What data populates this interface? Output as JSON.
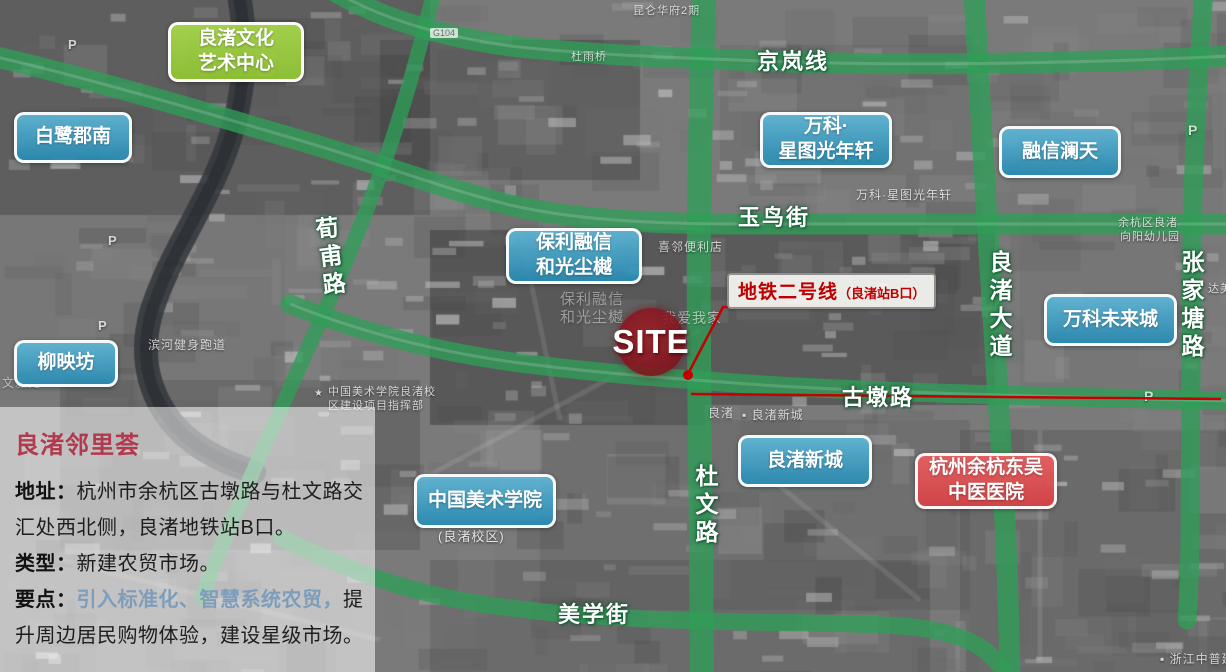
{
  "colors": {
    "road_green": "#2f9e57",
    "annotation_red": "#c40000",
    "site_fill_red": "#8c1622",
    "label_blue": "#2e94c0",
    "label_green": "#99c93c",
    "label_red": "#dd4f52",
    "panel_title_red": "#b13a4e",
    "panel_highlight_blue": "#7e9dbb"
  },
  "map": {
    "site_marker": {
      "label": "SITE"
    },
    "metro_callout": {
      "name": "地铁二号线",
      "station": "（良渚站B口）"
    },
    "place_labels": [
      {
        "id": "liangzhu-culture-art-center",
        "style": "green",
        "lines": [
          "良渚文化",
          "艺术中心"
        ],
        "x": 168,
        "y": 22,
        "w": 136,
        "h": 60
      },
      {
        "id": "bailu-jun-south",
        "style": "blue",
        "lines": [
          "白鹭郡南"
        ],
        "x": 14,
        "y": 112,
        "w": 118,
        "h": 51
      },
      {
        "id": "liuyingfang",
        "style": "blue",
        "lines": [
          "柳映坊"
        ],
        "x": 14,
        "y": 340,
        "w": 104,
        "h": 47
      },
      {
        "id": "baoli-rongxin-heguang-chenyue",
        "style": "blue",
        "lines": [
          "保利融信",
          "和光尘樾"
        ],
        "x": 506,
        "y": 228,
        "w": 136,
        "h": 56
      },
      {
        "id": "vanke-xingtu-guangnianxuan",
        "style": "blue",
        "lines": [
          "万科·",
          "星图光年轩"
        ],
        "x": 760,
        "y": 112,
        "w": 132,
        "h": 56
      },
      {
        "id": "rongxin-lantian",
        "style": "blue",
        "lines": [
          "融信澜天"
        ],
        "x": 999,
        "y": 126,
        "w": 122,
        "h": 52
      },
      {
        "id": "vanke-future-city",
        "style": "blue",
        "lines": [
          "万科未来城"
        ],
        "x": 1044,
        "y": 294,
        "w": 133,
        "h": 52
      },
      {
        "id": "liangzhu-new-town",
        "style": "blue",
        "lines": [
          "良渚新城"
        ],
        "x": 738,
        "y": 435,
        "w": 134,
        "h": 52
      },
      {
        "id": "china-academy-of-art",
        "style": "blue",
        "lines": [
          "中国美术学院"
        ],
        "x": 414,
        "y": 474,
        "w": 142,
        "h": 54
      },
      {
        "id": "hangzhou-yuhang-dongwu-hospital",
        "style": "red",
        "lines": [
          "杭州余杭东吴",
          "中医医院"
        ],
        "x": 915,
        "y": 453,
        "w": 142,
        "h": 56
      }
    ],
    "road_labels": [
      {
        "id": "jinglan-line",
        "text": "京岚线",
        "x": 757,
        "y": 44,
        "dir": "h"
      },
      {
        "id": "yuniao-street",
        "text": "玉鸟街",
        "x": 738,
        "y": 200,
        "dir": "h"
      },
      {
        "id": "gudun-road",
        "text": "古墩路",
        "x": 842,
        "y": 380,
        "dir": "h"
      },
      {
        "id": "meixue-street",
        "text": "美学街",
        "x": 558,
        "y": 597,
        "dir": "h"
      },
      {
        "id": "duwen-road",
        "text": "杜文路",
        "x": 688,
        "y": 464,
        "dir": "v"
      },
      {
        "id": "liangzhu-avenue",
        "text": "良渚大道",
        "x": 982,
        "y": 250,
        "dir": "v"
      },
      {
        "id": "zhangjiatang-road",
        "text": "张家塘路",
        "x": 1174,
        "y": 250,
        "dir": "v"
      },
      {
        "id": "xunfu-road",
        "text": "荀甫路",
        "x": 312,
        "y": 216,
        "dir": "v",
        "rot": -7
      }
    ],
    "base_texts": [
      {
        "text": "昆仑华府2期",
        "x": 633,
        "y": 2,
        "s": 11
      },
      {
        "text": "杜雨桥",
        "x": 571,
        "y": 48,
        "s": 11
      },
      {
        "text": "陆雨桥",
        "x": 243,
        "y": 50,
        "s": 11
      },
      {
        "text": "G104",
        "x": 430,
        "y": 28,
        "s": 9,
        "badge": true
      },
      {
        "text": "喜邻便利店",
        "x": 658,
        "y": 238,
        "s": 12
      },
      {
        "text": "保利融信",
        "x": 560,
        "y": 288,
        "s": 15,
        "o": 0.4
      },
      {
        "text": "和光尘樾",
        "x": 560,
        "y": 306,
        "s": 15,
        "o": 0.4
      },
      {
        "text": "我爱我家",
        "x": 662,
        "y": 308,
        "s": 14,
        "o": 0.55
      },
      {
        "text": "万科·星图光年轩",
        "x": 856,
        "y": 186,
        "s": 12
      },
      {
        "text": "★",
        "x": 314,
        "y": 388,
        "s": 10
      },
      {
        "text": "中国美术学院良渚校",
        "x": 328,
        "y": 383,
        "s": 11
      },
      {
        "text": "区建设项目指挥部",
        "x": 328,
        "y": 397,
        "s": 11
      },
      {
        "text": "滨河健身跑道",
        "x": 148,
        "y": 336,
        "s": 12
      },
      {
        "text": "文雅苑",
        "x": 2,
        "y": 374,
        "s": 12,
        "o": 0.5
      },
      {
        "text": "(良渚校区)",
        "x": 438,
        "y": 526,
        "s": 13,
        "o": 0.8
      },
      {
        "text": "良渚",
        "x": 708,
        "y": 404,
        "s": 12
      },
      {
        "text": "▪ 良渚新城",
        "x": 742,
        "y": 406,
        "s": 12
      },
      {
        "text": "余杭区良渚",
        "x": 1118,
        "y": 214,
        "s": 11
      },
      {
        "text": "向阳幼儿园",
        "x": 1120,
        "y": 228,
        "s": 11
      },
      {
        "text": "达美",
        "x": 1208,
        "y": 280,
        "s": 11
      },
      {
        "text": "▪ 浙江中普建工",
        "x": 1160,
        "y": 650,
        "s": 12
      },
      {
        "text": "P",
        "x": 68,
        "y": 37,
        "s": 13,
        "p": true
      },
      {
        "text": "P",
        "x": 108,
        "y": 233,
        "s": 13,
        "p": true
      },
      {
        "text": "P",
        "x": 98,
        "y": 318,
        "s": 13,
        "p": true
      },
      {
        "text": "P",
        "x": 1188,
        "y": 122,
        "s": 14,
        "p": true
      },
      {
        "text": "P",
        "x": 1144,
        "y": 388,
        "s": 14,
        "p": true
      }
    ]
  },
  "info_panel": {
    "title": "良渚邻里荟",
    "rows": [
      [
        {
          "t": "地址：",
          "b": true
        },
        {
          "t": "杭州市余杭区古墩路与杜文路交"
        }
      ],
      [
        {
          "t": "汇处西北侧，良渚地铁站B口。"
        }
      ],
      [
        {
          "t": "类型：",
          "b": true
        },
        {
          "t": "新建农贸市场。"
        }
      ],
      [
        {
          "t": "要点：",
          "b": true
        },
        {
          "t": "引入标准化、智慧系统农贸，",
          "hl": true
        },
        {
          "t": "提"
        }
      ],
      [
        {
          "t": "升周边居民购物体验，建设星级市场。"
        }
      ]
    ]
  }
}
